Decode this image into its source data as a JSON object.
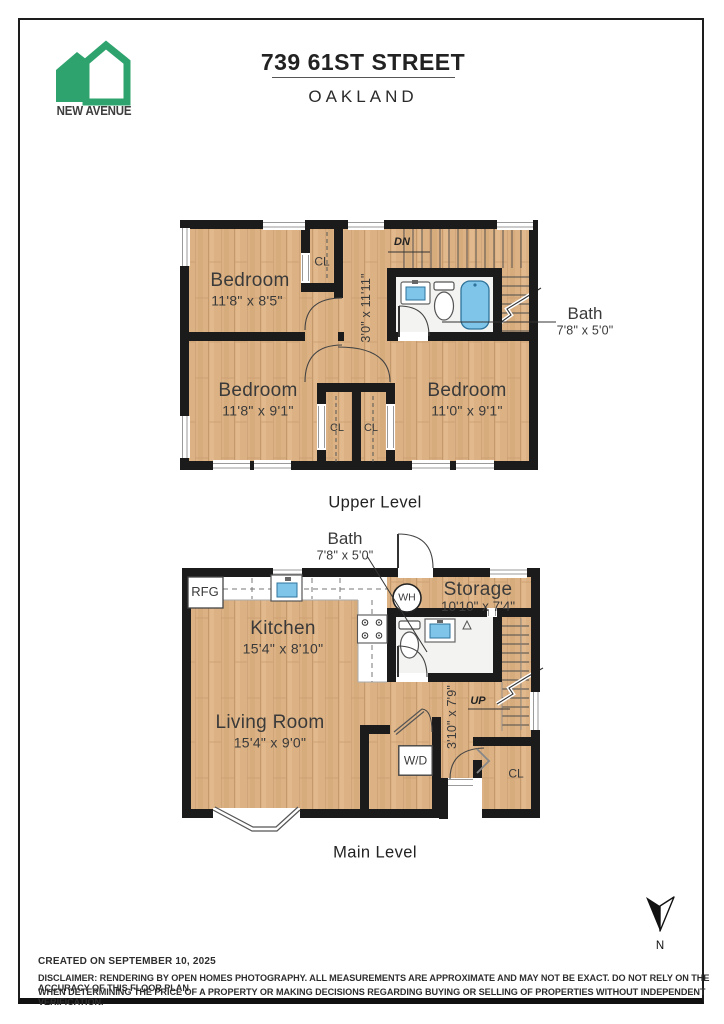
{
  "header": {
    "brand": "NEW AVENUE",
    "title": "739 61ST STREET",
    "subtitle": "OAKLAND"
  },
  "upper_level": {
    "title": "Upper Level",
    "bedroom1": {
      "name": "Bedroom",
      "dims": "11'8\" x 8'5\""
    },
    "bedroom2": {
      "name": "Bedroom",
      "dims": "11'8\" x 9'1\""
    },
    "bedroom3": {
      "name": "Bedroom",
      "dims": "11'0\" x 9'1\""
    },
    "bath": {
      "name": "Bath",
      "dims": "7'8\" x 5'0\""
    },
    "hall_dims": "3'0\" x 11'11\"",
    "closet_top": "CL",
    "closet_left": "CL",
    "closet_right": "CL",
    "stair_label": "DN"
  },
  "main_level": {
    "title": "Main Level",
    "kitchen": {
      "name": "Kitchen",
      "dims": "15'4\" x 8'10\""
    },
    "living_room": {
      "name": "Living Room",
      "dims": "15'4\" x 9'0\""
    },
    "storage": {
      "name": "Storage",
      "dims": "10'10\" x 7'4\""
    },
    "bath": {
      "name": "Bath",
      "dims": "7'8\" x 5'0\""
    },
    "hall_dims": "3'10\" x 7'9\"",
    "refrigerator": "RFG",
    "water_heater": "WH",
    "washer_dryer": "W/D",
    "closet": "CL",
    "stair_label": "UP"
  },
  "compass": {
    "north": "N"
  },
  "footer": {
    "created": "CREATED ON SEPTEMBER 10, 2025",
    "disclaimer1": "DISCLAIMER: RENDERING BY OPEN HOMES PHOTOGRAPHY. ALL MEASUREMENTS ARE APPROXIMATE AND MAY NOT BE EXACT. DO NOT RELY ON THE ACCURACY OF THIS FLOOR PLAN",
    "disclaimer2": "WHEN DETERMINING THE PRICE OF A PROPERTY OR MAKING DECISIONS REGARDING BUYING OR SELLING OF PROPERTIES WITHOUT INDEPENDENT VERIFICATION."
  },
  "colors": {
    "brand_green": "#2FA36E",
    "wall": "#1b1b1b",
    "wood": "#DCB285",
    "fixture_blue": "#7FC5E9"
  }
}
